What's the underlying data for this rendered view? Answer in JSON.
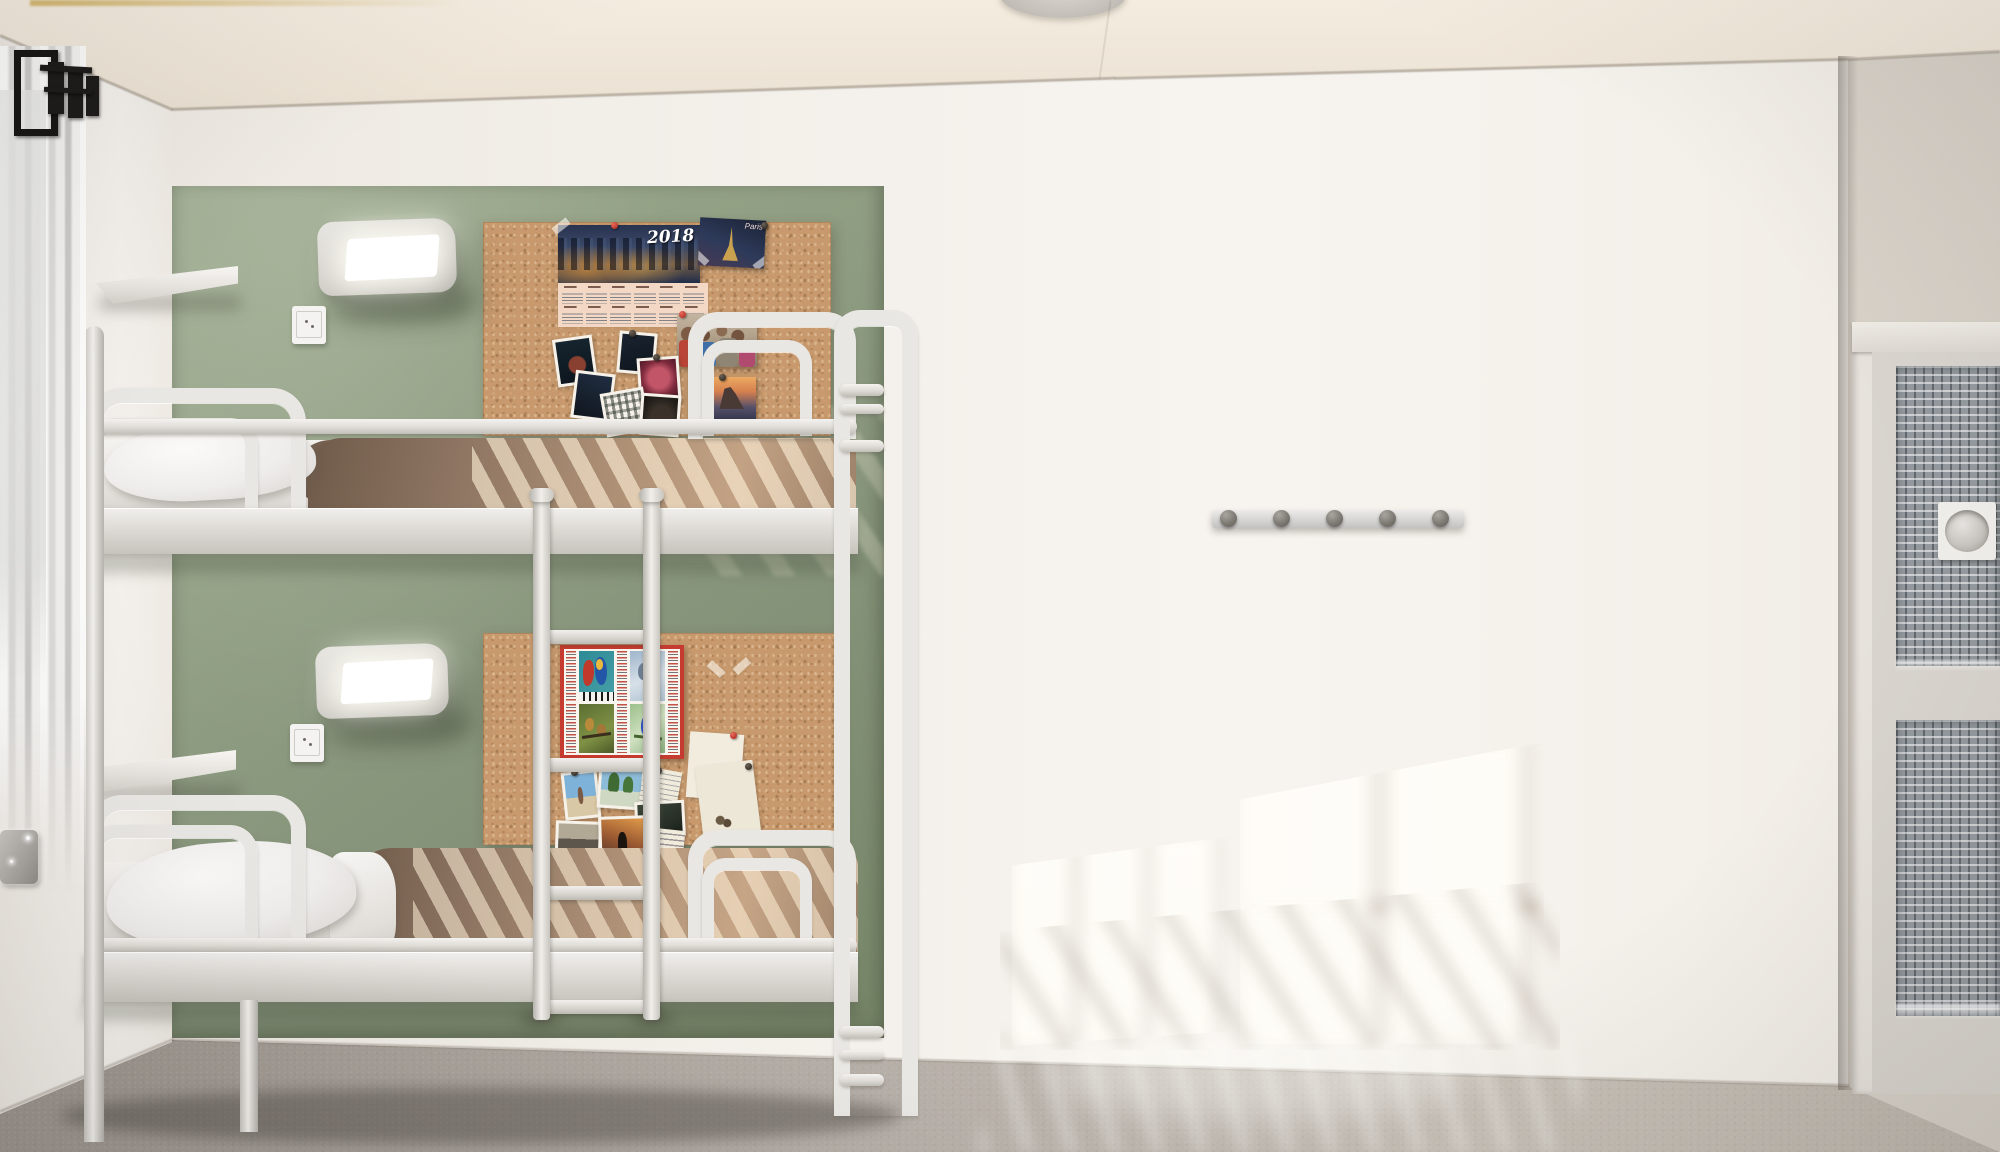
{
  "meta": {
    "scene": "3D render of a hostel dormitory room",
    "view": "front elevation"
  },
  "labels": {
    "calendar_year": "2018",
    "paris_caption": "Paris"
  },
  "counts": {
    "coat_hooks": 5,
    "bunk_levels": 2,
    "cork_boards": 2,
    "wall_lamps": 2,
    "power_outlets": 2,
    "wall_shelves": 2,
    "ladder_rungs": 4
  },
  "colors": {
    "accent_wall_green": "#8f9d82",
    "back_wall_white": "#f2eee8",
    "ceiling_cream": "#ece3d5",
    "floor_concrete": "#b6afa8",
    "cork_board": "#c7996d",
    "bed_frame_white": "#e9e7e3",
    "blanket_brown": "#8a7260",
    "bird_poster_red": "#c63b2f",
    "hook_metal": "#7d7973",
    "mesh_door_grey": "#949a9f"
  }
}
